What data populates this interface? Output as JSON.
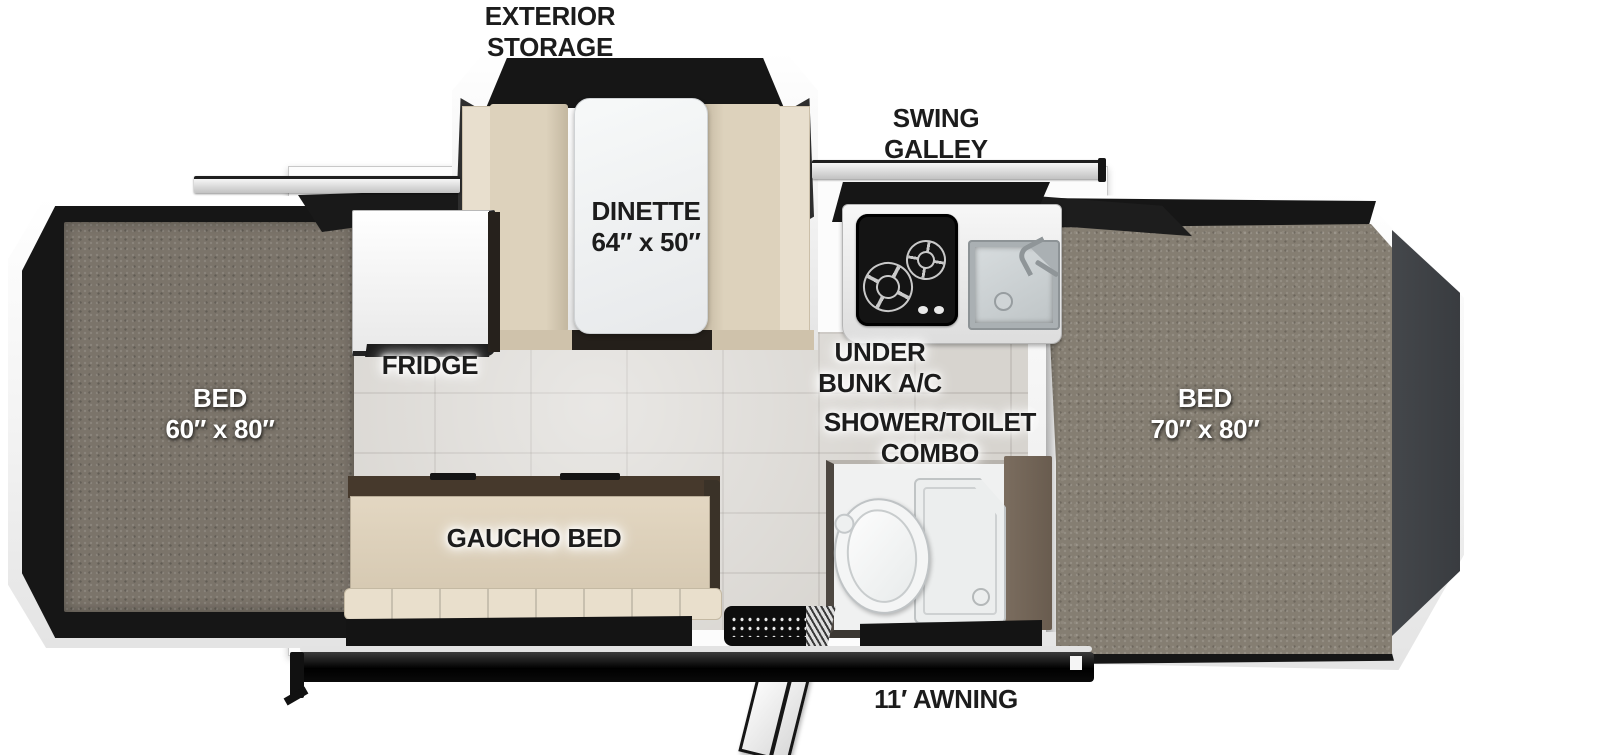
{
  "page": {
    "type": "Pop-up camper floor plan diagram, top-down view",
    "width_px": 1600,
    "height_px": 755,
    "background": "#ffffff"
  },
  "palette": {
    "shell_white": "#f6f6f6",
    "tent_canvas_black": "#161616",
    "mattress_carpet_gray": "#7b746a",
    "bunk_deck_carpet": "#857e72",
    "floor_tile_gray": "#d7d4cf",
    "bench_beige": "#ddd2bc",
    "bench_beige_light": "#e8dfce",
    "gaucho_beige": "#ddd1bb",
    "gaucho_top_brown": "#46392c",
    "partition_brown": "#7b6d5f",
    "bunk_end_panel_gray": "#3f4246",
    "stove_black": "#141414",
    "sink_basin_gray": "#cdd2d4",
    "counter_white": "#f3f3f3",
    "awning_bar_black": "#0e0e0e",
    "label_black": "#1c1c1c",
    "label_white": "#ffffff"
  },
  "labels": {
    "exterior_storage": {
      "line1": "EXTERIOR",
      "line2": "STORAGE"
    },
    "swing_galley": {
      "line1": "SWING",
      "line2": "GALLEY"
    },
    "dinette": {
      "line1": "DINETTE",
      "line2": "64″ x 50″"
    },
    "fridge": {
      "text": "FRIDGE"
    },
    "bed_left": {
      "line1": "BED",
      "line2": "60″ x 80″"
    },
    "under_bunk_ac": {
      "line1": "UNDER",
      "line2": "BUNK A/C"
    },
    "shower_toilet": {
      "line1": "SHOWER/TOILET",
      "line2": "COMBO"
    },
    "bed_right": {
      "line1": "BED",
      "line2": "70″ x 80″"
    },
    "gaucho_bed": {
      "text": "GAUCHO BED"
    },
    "awning": {
      "text": "11′ AWNING"
    }
  }
}
